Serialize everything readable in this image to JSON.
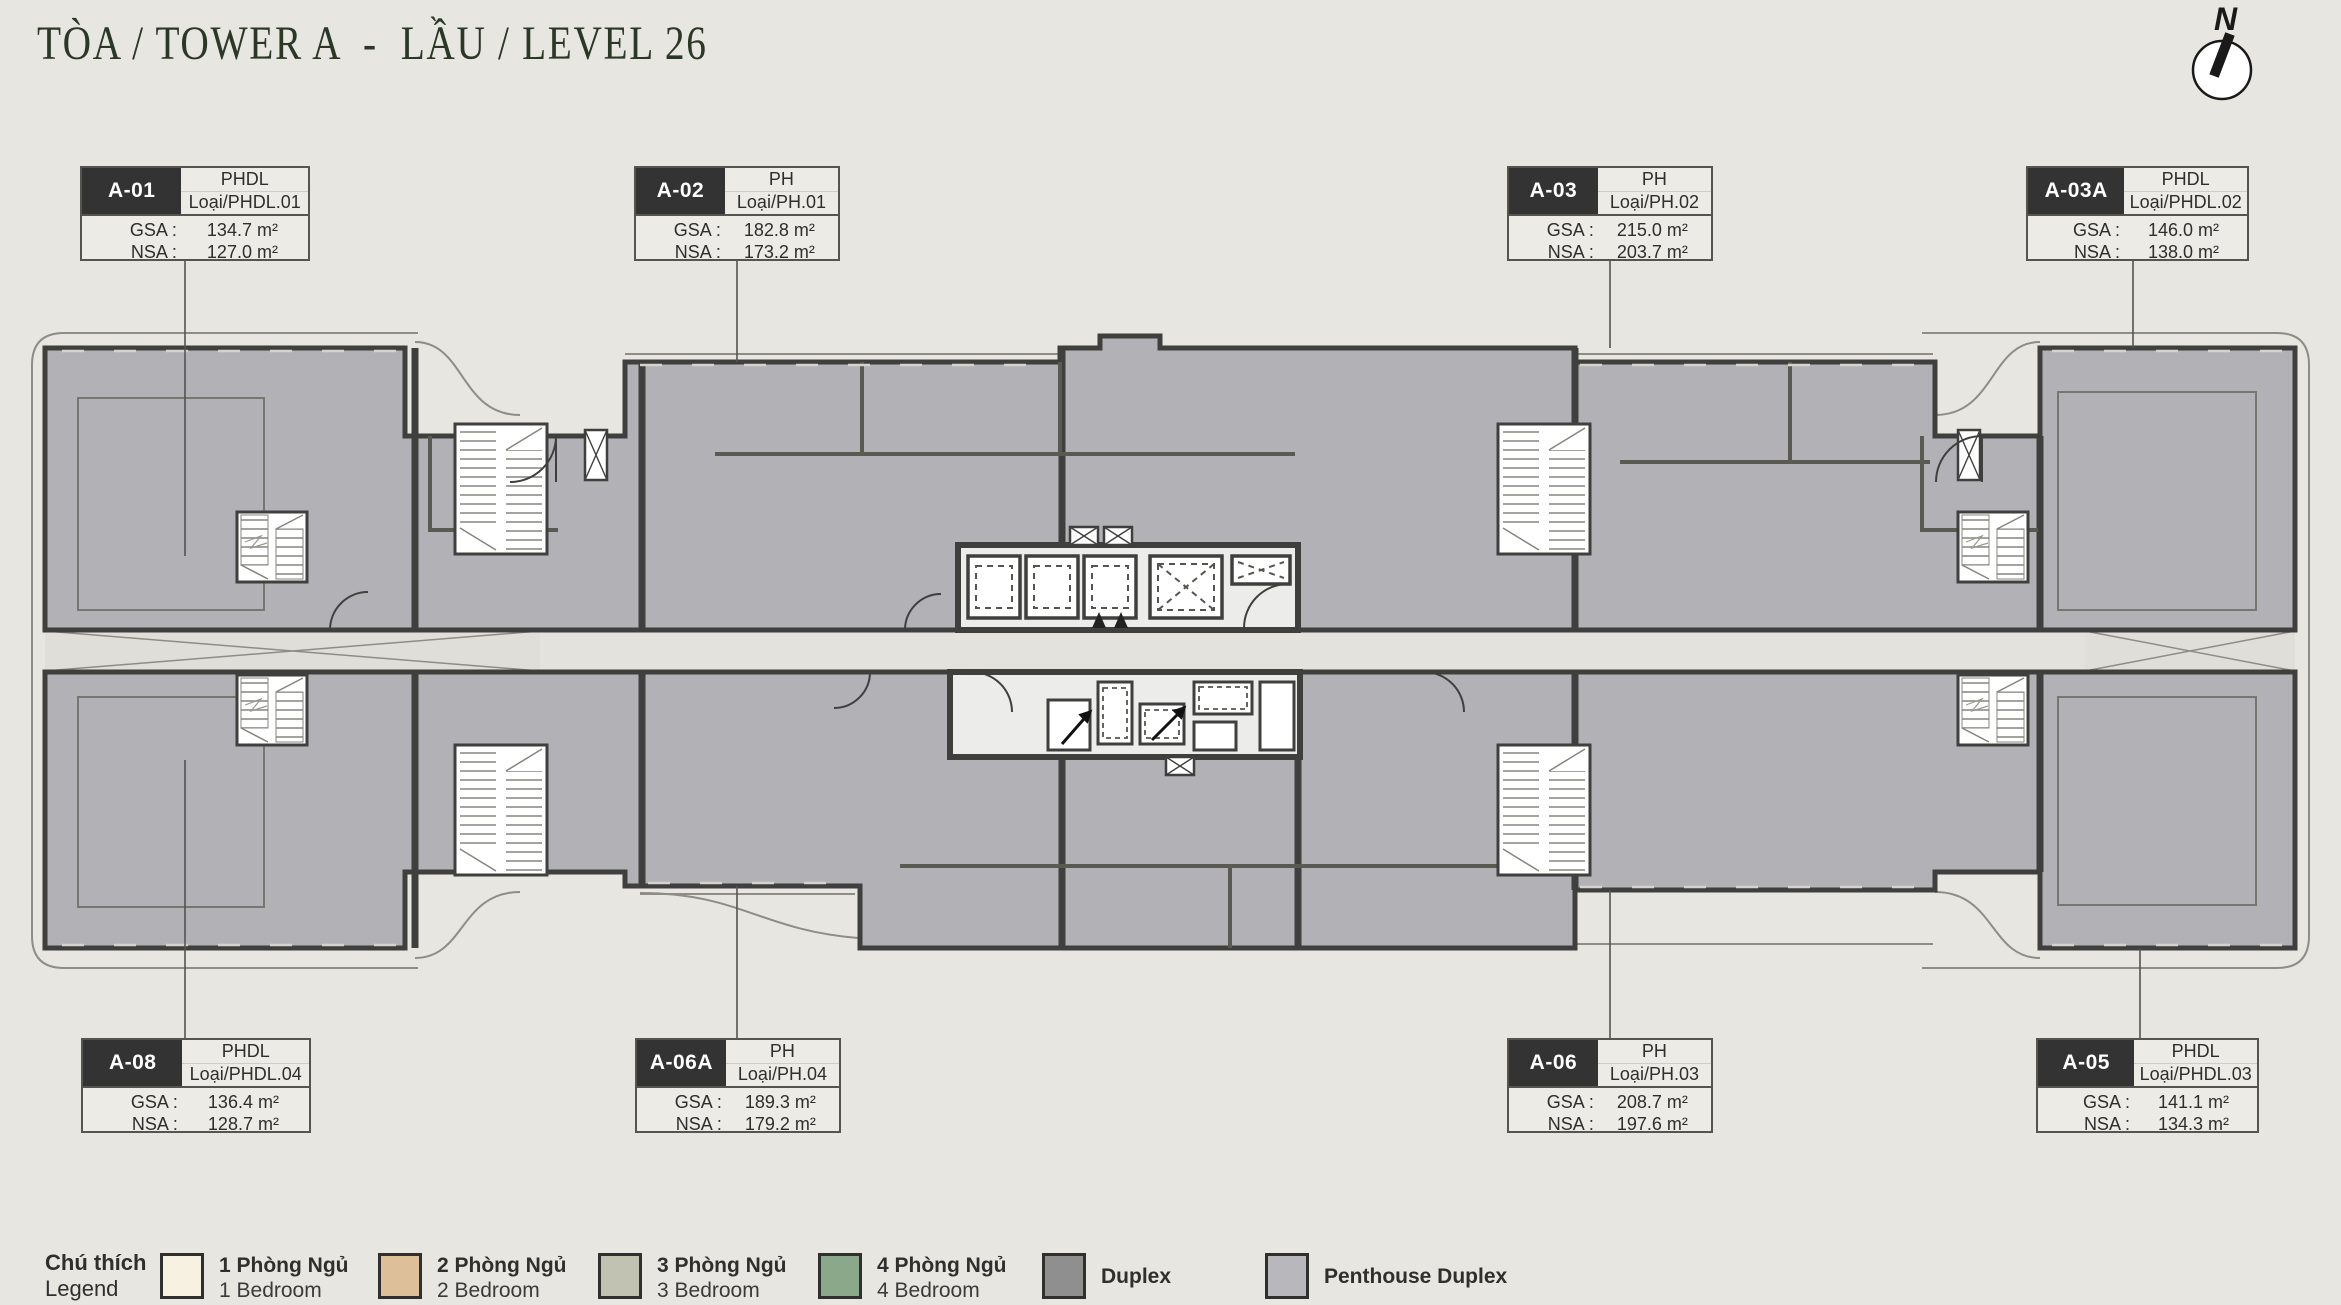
{
  "title": "TÒA / TOWER A  -  LẦU / LEVEL 26",
  "compass": {
    "label": "N"
  },
  "units": [
    {
      "id": "A-01",
      "type": "PHDL",
      "type_code": "Loại/PHDL.01",
      "gsa_label": "GSA :",
      "gsa_value": "134.7 m²",
      "nsa_label": "NSA :",
      "nsa_value": "127.0 m²"
    },
    {
      "id": "A-02",
      "type": "PH",
      "type_code": "Loại/PH.01",
      "gsa_label": "GSA :",
      "gsa_value": "182.8 m²",
      "nsa_label": "NSA :",
      "nsa_value": "173.2 m²"
    },
    {
      "id": "A-03",
      "type": "PH",
      "type_code": "Loại/PH.02",
      "gsa_label": "GSA :",
      "gsa_value": "215.0 m²",
      "nsa_label": "NSA :",
      "nsa_value": "203.7 m²"
    },
    {
      "id": "A-03A",
      "type": "PHDL",
      "type_code": "Loại/PHDL.02",
      "gsa_label": "GSA :",
      "gsa_value": "146.0 m²",
      "nsa_label": "NSA :",
      "nsa_value": "138.0 m²"
    },
    {
      "id": "A-08",
      "type": "PHDL",
      "type_code": "Loại/PHDL.04",
      "gsa_label": "GSA :",
      "gsa_value": "136.4 m²",
      "nsa_label": "NSA :",
      "nsa_value": "128.7 m²"
    },
    {
      "id": "A-06A",
      "type": "PH",
      "type_code": "Loại/PH.04",
      "gsa_label": "GSA :",
      "gsa_value": "189.3 m²",
      "nsa_label": "NSA :",
      "nsa_value": "179.2 m²"
    },
    {
      "id": "A-06",
      "type": "PH",
      "type_code": "Loại/PH.03",
      "gsa_label": "GSA :",
      "gsa_value": "208.7 m²",
      "nsa_label": "NSA :",
      "nsa_value": "197.6 m²"
    },
    {
      "id": "A-05",
      "type": "PHDL",
      "type_code": "Loại/PHDL.03",
      "gsa_label": "GSA :",
      "gsa_value": "141.1 m²",
      "nsa_label": "NSA :",
      "nsa_value": "134.3 m²"
    }
  ],
  "legend": {
    "heading_vi": "Chú thích",
    "heading_en": "Legend",
    "items": [
      {
        "label_vi": "1 Phòng Ngủ",
        "label_en": "1 Bedroom",
        "color": "#f7f1e1"
      },
      {
        "label_vi": "2 Phòng Ngủ",
        "label_en": "2 Bedroom",
        "color": "#ddc09a"
      },
      {
        "label_vi": "3 Phòng Ngủ",
        "label_en": "3 Bedroom",
        "color": "#c2c2b2"
      },
      {
        "label_vi": "4 Phòng Ngủ",
        "label_en": "4 Bedroom",
        "color": "#8ca88b"
      },
      {
        "label_vi": "Duplex",
        "label_en": "",
        "color": "#8f8f8f"
      },
      {
        "label_vi": "Penthouse Duplex",
        "label_en": "",
        "color": "#b7b7bc"
      }
    ]
  },
  "colors": {
    "background": "#e8e6e1",
    "unit_fill": "#b1b1b6",
    "wall": "#3f3f3e",
    "corridor": "#e4e2dd",
    "label_dark_cell": "#333333",
    "title": "#2c3826"
  }
}
